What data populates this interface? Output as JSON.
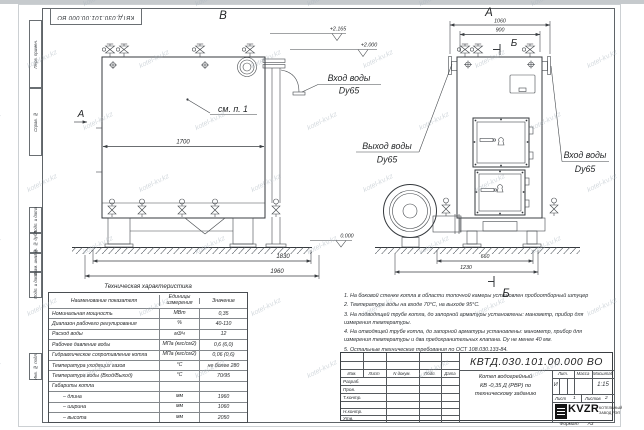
{
  "sheet": {
    "stamp": "КВТД.030.101.00.000 ВО",
    "side_labels": [
      "Перв. примен.",
      "Справ. №",
      "Подп. и дата",
      "Инв. № дубл.",
      "Взам. инв. №",
      "Подп. и дата",
      "Инв. № подл."
    ],
    "format_label": "Формат",
    "format_value": "А3"
  },
  "drawing": {
    "view_b": "В",
    "view_a_side": "А",
    "view_a_front": "А",
    "section_b": "Б",
    "see_item": "см. п. 1",
    "inlet1": [
      "Вход воды",
      "Dy65"
    ],
    "outlet": [
      "Выход воды",
      "Dy65"
    ],
    "inlet2": [
      "Вход воды",
      "Dy65"
    ],
    "elevations": [
      "+2.165",
      "+2.000",
      "0.000"
    ],
    "dims": {
      "d1700": "1700",
      "d1830": "1830",
      "d1960": "1960",
      "d1060": "1060",
      "d900": "900",
      "d660": "660",
      "d1230": "1230"
    }
  },
  "table": {
    "title": "Техническая характеристика",
    "headers": [
      "Наименование показателя",
      "Единицы измерения",
      "Значение"
    ],
    "rows": [
      [
        "Номинальная мощность",
        "МВт",
        "0,35"
      ],
      [
        "Диапазон рабочего регулирования",
        "%",
        "40-110"
      ],
      [
        "Расход воды",
        "м3/ч",
        "12"
      ],
      [
        "Рабочее давление воды",
        "МПа (кгс/см2)",
        "0,6 (6,0)"
      ],
      [
        "Гидравлическое сопротивление котла",
        "МПа (кгс/см2)",
        "0,06 (0,6)"
      ],
      [
        "Температура уходящих газов",
        "°С",
        "не более 280"
      ],
      [
        "Температура воды (Вход/Выход)",
        "°С",
        "70/95"
      ],
      [
        "Габариты котла",
        "",
        ""
      ],
      [
        "– длина",
        "мм",
        "1960"
      ],
      [
        "– ширина",
        "мм",
        "1060"
      ],
      [
        "– высота",
        "мм",
        "2050"
      ]
    ]
  },
  "notes": [
    "1. На боковой стенке котла в области топочной камеры установлен пробоотборный штуцер",
    "2. Температура воды на входе 70°С, на выходе 95°С.",
    "3. На подводящей трубе котла, до запорной арматуры установлены: манометр, прибор для измерения температуры.",
    "4. На отводящей трубе котла, до запорной арматуры установлены: манометр, прибор для измерения температуры и два предохранительных клапана. Dу не менее 40 мм.",
    "5. Остальные технические требования по ОСТ 108.030.133-84."
  ],
  "titleblock": {
    "doc_number": "КВТД.030.101.00.000  ВО",
    "product": [
      "Котел водогрейный",
      "КВ -0,35 Д (РВР) по",
      "техническому заданию"
    ],
    "header_cols": [
      "Изм.",
      "Лист",
      "N докум.",
      "Подп.",
      "Дата"
    ],
    "role_rows": [
      "Разраб.",
      "Пров.",
      "Т.контр.",
      "",
      "Н.контр.",
      "Утв."
    ],
    "lit_label": "Лит.",
    "mass_label": "Масса",
    "scale_label": "Масштаб",
    "lit_value": "И",
    "scale_value": "1:15",
    "sheet_label": "Лист",
    "sheet_value": "1",
    "sheets_label": "Листов",
    "sheets_value": "2",
    "logo": {
      "text": "KVZR",
      "sub1": "КОТЕЛЬНЫЙ",
      "sub2": "ЗАВОД РЭП"
    }
  },
  "watermark": {
    "text": "kotel-kv.kz"
  }
}
